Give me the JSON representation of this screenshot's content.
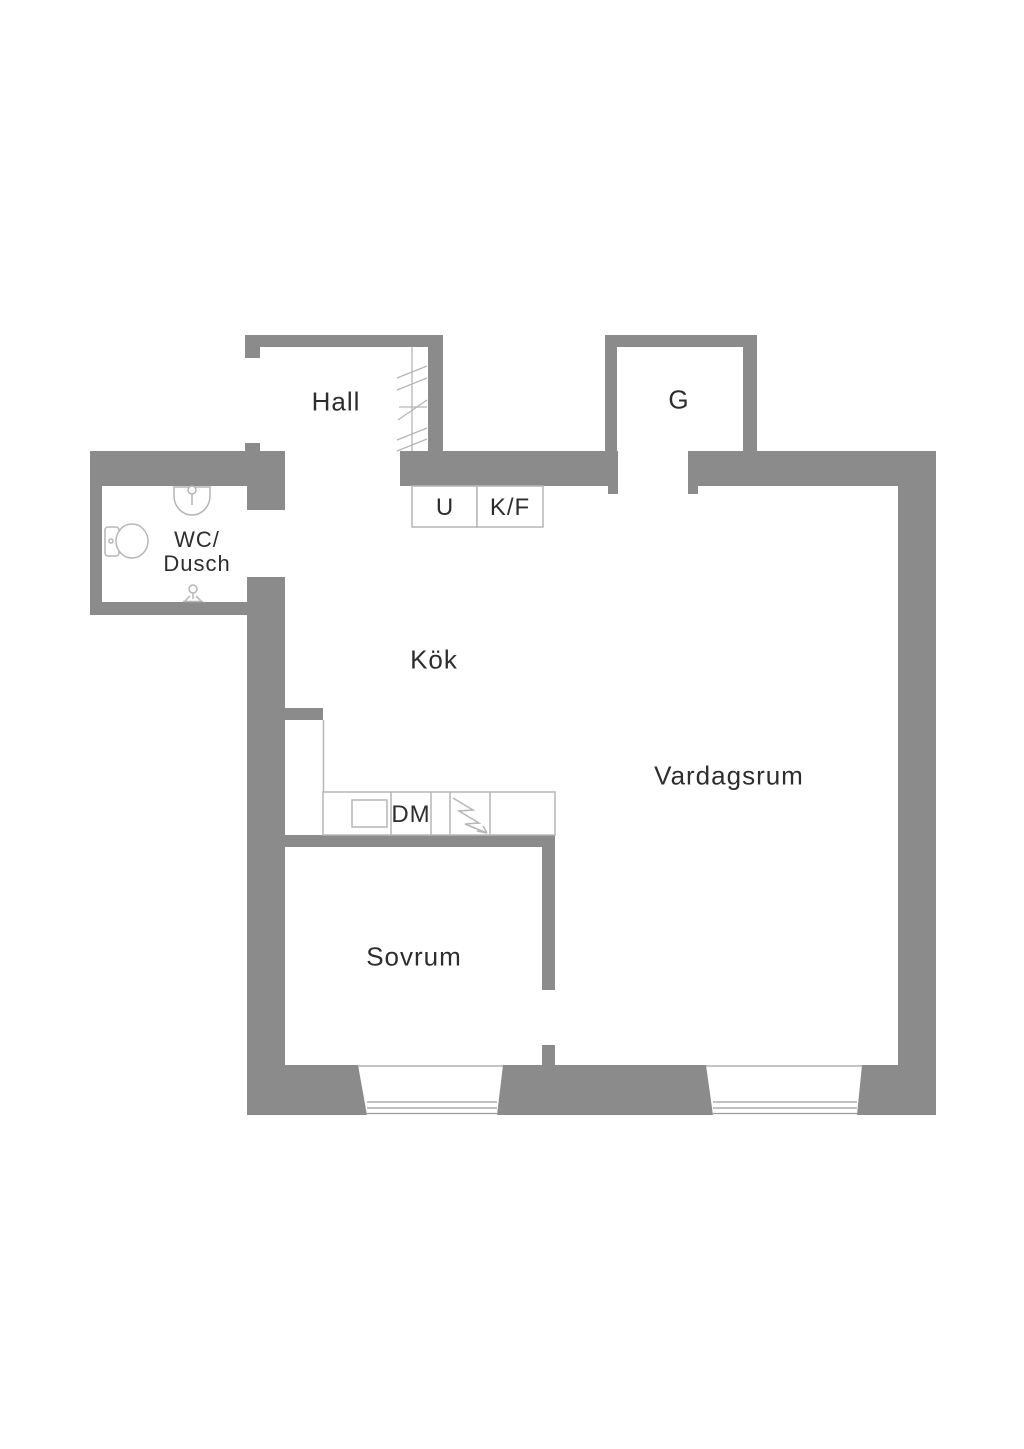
{
  "title": "Apartment floor plan",
  "rooms": {
    "hall": "Hall",
    "closet": "G",
    "wc_line1": "WC/",
    "wc_line2": "Dusch",
    "kitchen": "Kök",
    "living": "Vardagsrum",
    "bedroom": "Sovrum"
  },
  "fixtures": {
    "cabinet": "U",
    "fridge_freezer": "K/F",
    "dishwasher": "DM"
  },
  "colors": {
    "wall": "#8b8b8b",
    "thin_outline": "#b6b6b6",
    "window_glass": "#9c9c9c",
    "text": "#2d2d2d",
    "background": "#ffffff"
  }
}
